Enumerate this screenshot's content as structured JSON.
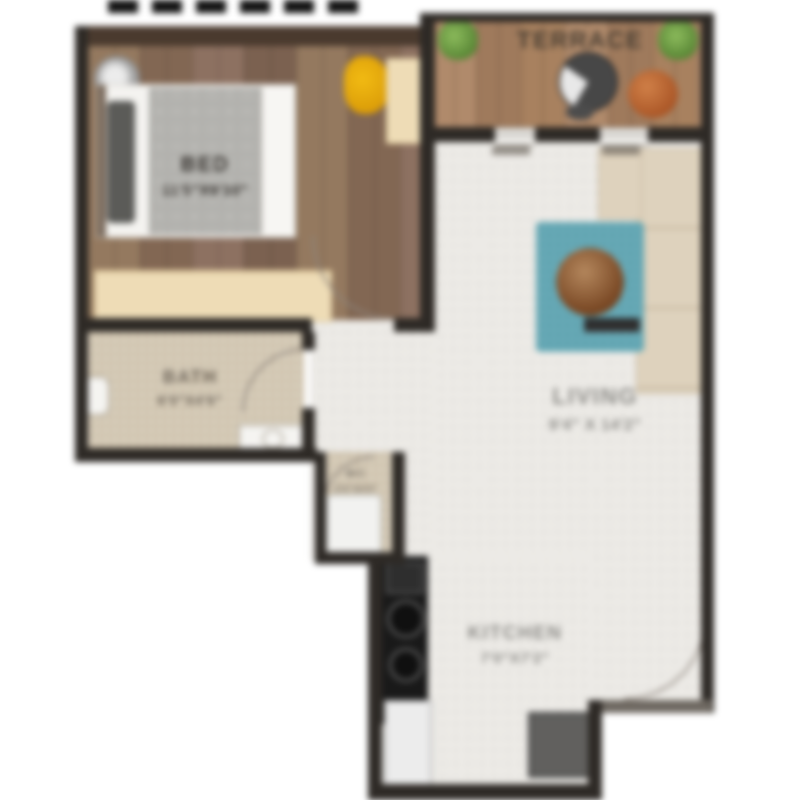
{
  "plan": {
    "rooms": {
      "bed": {
        "name": "BED",
        "dims": "11'5\"X9'10\""
      },
      "terrace": {
        "name": "TERRACE"
      },
      "living": {
        "name": "LIVING",
        "dims": "9'4\" X 14'2\""
      },
      "bath": {
        "name": "BATH",
        "dims": "6'0\"X4'6\""
      },
      "wc": {
        "name": "WC",
        "dims": "2'6\"X4'0\""
      },
      "kitchen": {
        "name": "KITCHEN",
        "dims": "7'0\"X7'2\""
      }
    },
    "colors": {
      "wall": "#2e2a26",
      "wood_floor": "#8a7260",
      "terrace_deck": "#a58466",
      "tile_light": "#edebe7",
      "bath_mosaic": "#cfc3ad",
      "rug": "#58a2b0",
      "sofa": "#ded2bd",
      "accent_chair": "#e6a711",
      "terracotta_pot": "#b15e2e",
      "plant": "#69a24b",
      "cream_furniture": "#eedcb6",
      "kitchen_counter": "#191919"
    }
  }
}
